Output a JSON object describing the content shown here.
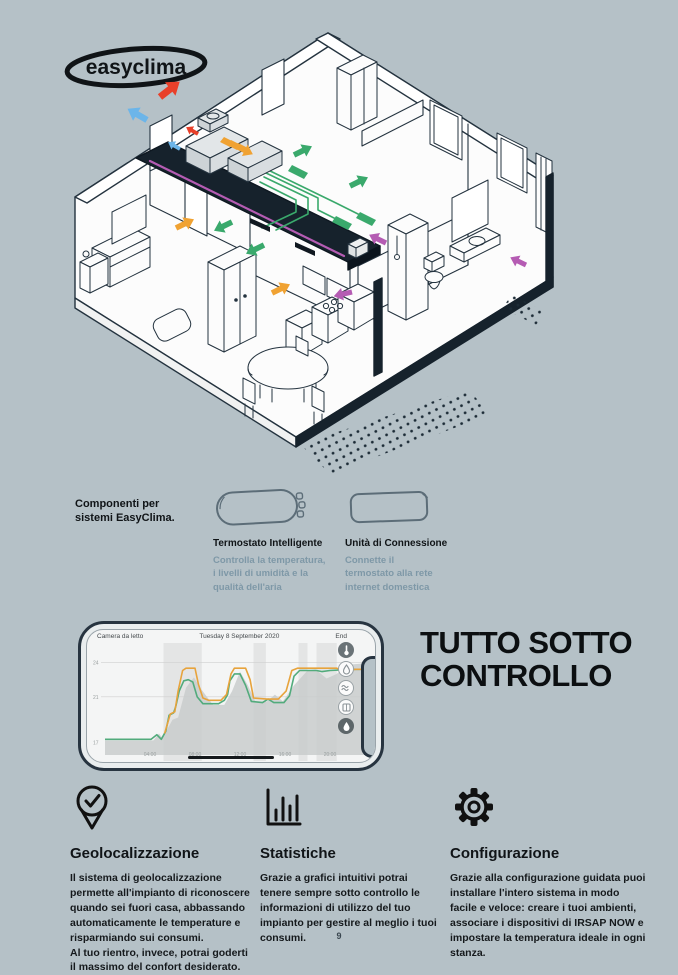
{
  "page": {
    "background_color": "#b5c1c7"
  },
  "logo": {
    "text": "easyclima"
  },
  "illustration": {
    "type": "isometric-house-cutaway",
    "colors": {
      "warm_air_arrow": "#e8402a",
      "cool_air_arrow": "#6cb5e9",
      "fresh_air_arrow": "#3aa96c",
      "extract_air_arrow": "#f0a232",
      "exhaust_arrow": "#b55cb3",
      "ceiling_duct": "#16222c"
    }
  },
  "components": {
    "heading": "Componenti per\nsistemi EasyClima.",
    "items": [
      {
        "icon": "thermostat-device",
        "name": "Termostato Intelligente",
        "description": "Controlla la temperatura,\ni livelli di umidità e la\nqualità dell'aria"
      },
      {
        "icon": "connection-unit-device",
        "name": "Unità di Connessione",
        "description": "Connette il\ntermostato alla rete\ninternet domestica"
      }
    ]
  },
  "phone": {
    "room_label": "Camera da letto",
    "date_label": "Tuesday 8 September 2020",
    "end_label": "End",
    "side_icons": [
      "thermometer-icon",
      "water-drop-icon",
      "waves-icon",
      "window-icon",
      "humidity-icon"
    ]
  },
  "chart_data": {
    "type": "line",
    "title": "",
    "xlabel": "",
    "ylabel": "",
    "xlim": [
      0,
      24
    ],
    "ylim": [
      17,
      24
    ],
    "grid": true,
    "legend": false,
    "x_ticks": [
      {
        "hour": 4,
        "label": "04:00"
      },
      {
        "hour": 8,
        "label": "08:00"
      },
      {
        "hour": 12,
        "label": "12:00"
      },
      {
        "hour": 16,
        "label": "16:00"
      },
      {
        "hour": 20,
        "label": "20:00"
      }
    ],
    "y_ticks": [
      {
        "value": 24,
        "label": "24"
      },
      {
        "value": 21,
        "label": "21"
      },
      {
        "value": 17,
        "label": "17"
      }
    ],
    "shaded_bands_hours": [
      [
        5.2,
        8.6
      ],
      [
        13.2,
        14.3
      ],
      [
        17.2,
        18.0
      ],
      [
        18.8,
        20.6
      ]
    ],
    "series": [
      {
        "name": "gray-area",
        "style": "area",
        "color": "#c9cdcc",
        "points": [
          [
            0,
            17.2
          ],
          [
            4.3,
            17.2
          ],
          [
            4.8,
            17.8
          ],
          [
            5.1,
            17.4
          ],
          [
            6.0,
            19.0
          ],
          [
            6.5,
            19.2
          ],
          [
            7.2,
            21.8
          ],
          [
            7.9,
            22.7
          ],
          [
            8.6,
            21.6
          ],
          [
            9.6,
            20.3
          ],
          [
            10.6,
            20.3
          ],
          [
            11.3,
            21.5
          ],
          [
            12.0,
            23.2
          ],
          [
            12.7,
            22.0
          ],
          [
            13.4,
            20.5
          ],
          [
            14.4,
            20.6
          ],
          [
            15.1,
            21.2
          ],
          [
            15.8,
            20.6
          ],
          [
            16.8,
            22.0
          ],
          [
            18.0,
            23.3
          ],
          [
            18.7,
            23.4
          ],
          [
            19.7,
            22.6
          ],
          [
            20.6,
            23.0
          ],
          [
            21.6,
            23.8
          ],
          [
            22.8,
            23.9
          ],
          [
            24,
            24.0
          ]
        ]
      },
      {
        "name": "green-line",
        "style": "line",
        "color": "#52ab7c",
        "points": [
          [
            0,
            17.3
          ],
          [
            4.1,
            17.3
          ],
          [
            4.6,
            17.7
          ],
          [
            5.0,
            17.3
          ],
          [
            5.4,
            18.0
          ],
          [
            5.7,
            19.4
          ],
          [
            6.1,
            19.6
          ],
          [
            6.3,
            20.2
          ],
          [
            6.6,
            21.5
          ],
          [
            7.0,
            22.4
          ],
          [
            7.4,
            22.5
          ],
          [
            7.8,
            22.3
          ],
          [
            8.2,
            21.0
          ],
          [
            8.7,
            20.4
          ],
          [
            10.1,
            20.4
          ],
          [
            10.6,
            20.7
          ],
          [
            10.9,
            21.2
          ],
          [
            11.1,
            22.4
          ],
          [
            11.5,
            23.0
          ],
          [
            12.0,
            23.0
          ],
          [
            12.5,
            22.0
          ],
          [
            13.0,
            20.6
          ],
          [
            14.0,
            20.5
          ],
          [
            14.5,
            20.8
          ],
          [
            15.0,
            20.5
          ],
          [
            15.9,
            20.5
          ],
          [
            16.4,
            21.1
          ],
          [
            16.8,
            22.8
          ],
          [
            17.3,
            23.3
          ],
          [
            18.8,
            23.3
          ],
          [
            19.3,
            23.2
          ],
          [
            20.0,
            23.3
          ],
          [
            22.0,
            23.4
          ],
          [
            24,
            23.4
          ]
        ]
      },
      {
        "name": "orange-line",
        "style": "line",
        "color": "#e7a33c",
        "points": [
          [
            5.3,
            17.8
          ],
          [
            5.8,
            19.5
          ],
          [
            6.2,
            19.7
          ],
          [
            6.5,
            21.5
          ],
          [
            6.9,
            23.3
          ],
          [
            7.2,
            23.5
          ],
          [
            8.0,
            23.5
          ],
          [
            8.3,
            22.1
          ],
          [
            8.7,
            20.9
          ],
          [
            9.2,
            20.7
          ],
          [
            10.3,
            20.7
          ],
          [
            10.8,
            21.2
          ],
          [
            11.2,
            23.0
          ],
          [
            11.5,
            23.5
          ],
          [
            12.5,
            23.5
          ],
          [
            12.9,
            22.5
          ],
          [
            13.2,
            20.9
          ],
          [
            14.4,
            20.8
          ],
          [
            15.4,
            20.8
          ],
          [
            16.1,
            21.5
          ],
          [
            16.6,
            23.3
          ],
          [
            17.1,
            23.5
          ],
          [
            19.2,
            23.5
          ],
          [
            20.6,
            23.5
          ],
          [
            21.1,
            23.3
          ],
          [
            22.3,
            23.4
          ],
          [
            24,
            23.4
          ]
        ]
      }
    ]
  },
  "hero": {
    "title": "TUTTO SOTTO\nCONTROLLO"
  },
  "features": [
    {
      "icon": "location-pin-check-icon",
      "title": "Geolocalizzazione",
      "body": "Il sistema di geolocalizzazione permette all'impianto di riconoscere quando sei fuori casa, abbassando automaticamente le temperature e risparmiando sui consumi.\nAl tuo rientro, invece, potrai goderti il massimo del confort desiderato."
    },
    {
      "icon": "bar-chart-icon",
      "title": "Statistiche",
      "body": "Grazie a grafici intuitivi potrai tenere sempre sotto controllo le informazioni di utilizzo del tuo impianto per gestire al meglio i tuoi consumi."
    },
    {
      "icon": "gear-icon",
      "title": "Configurazione",
      "body": "Grazie alla configurazione guidata puoi installare l'intero sistema in modo facile e veloce: creare i tuoi ambienti, associare i dispositivi di IRSAP NOW e impostare la temperatura ideale in ogni stanza."
    }
  ],
  "footer": {
    "page_number": "9"
  }
}
